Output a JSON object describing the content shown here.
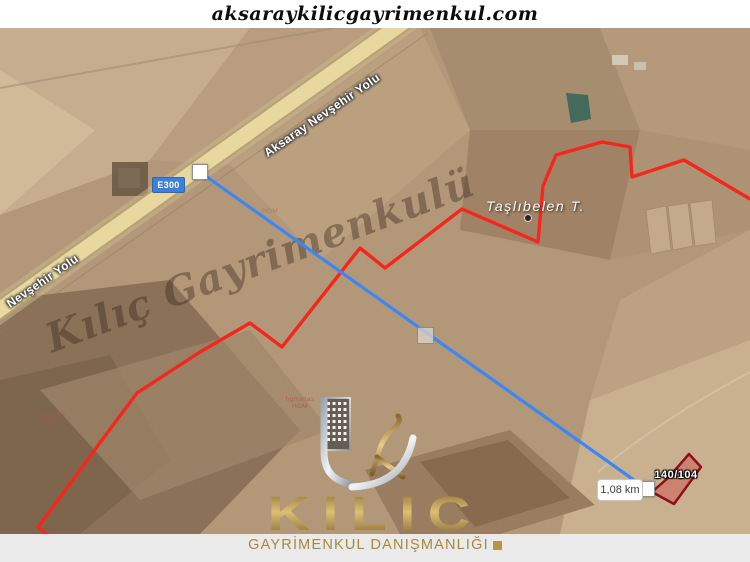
{
  "header": {
    "site_url": "aksaraykilicgayrimenkul.com"
  },
  "map": {
    "route_badge": "E300",
    "road_label_main": "Aksaray Nevşehir Yolu",
    "road_label_secondary": "Nevşehir Yolu",
    "place_label": "Taşlıbelen T.",
    "watermark_text": "Kılıç Gayrimenkulü",
    "distance_label": "1,08 km",
    "parcel_label": "140/104",
    "source_label": {
      "line1": "hgmatlas",
      "line2": "HGM"
    },
    "colors": {
      "boundary_red": "#f3271d",
      "measure_blue": "#3b87f5",
      "road_fill": "#e9d7a0",
      "badge_blue": "#3e7fd7",
      "parcel_fill": "rgba(205,85,80,0.5)",
      "parcel_stroke": "#8e0e1a",
      "gold": "#b4954a"
    }
  },
  "branding": {
    "logo_text": "KILIC",
    "tagline": "GAYRİMENKUL DANIŞMANLIĞI"
  }
}
